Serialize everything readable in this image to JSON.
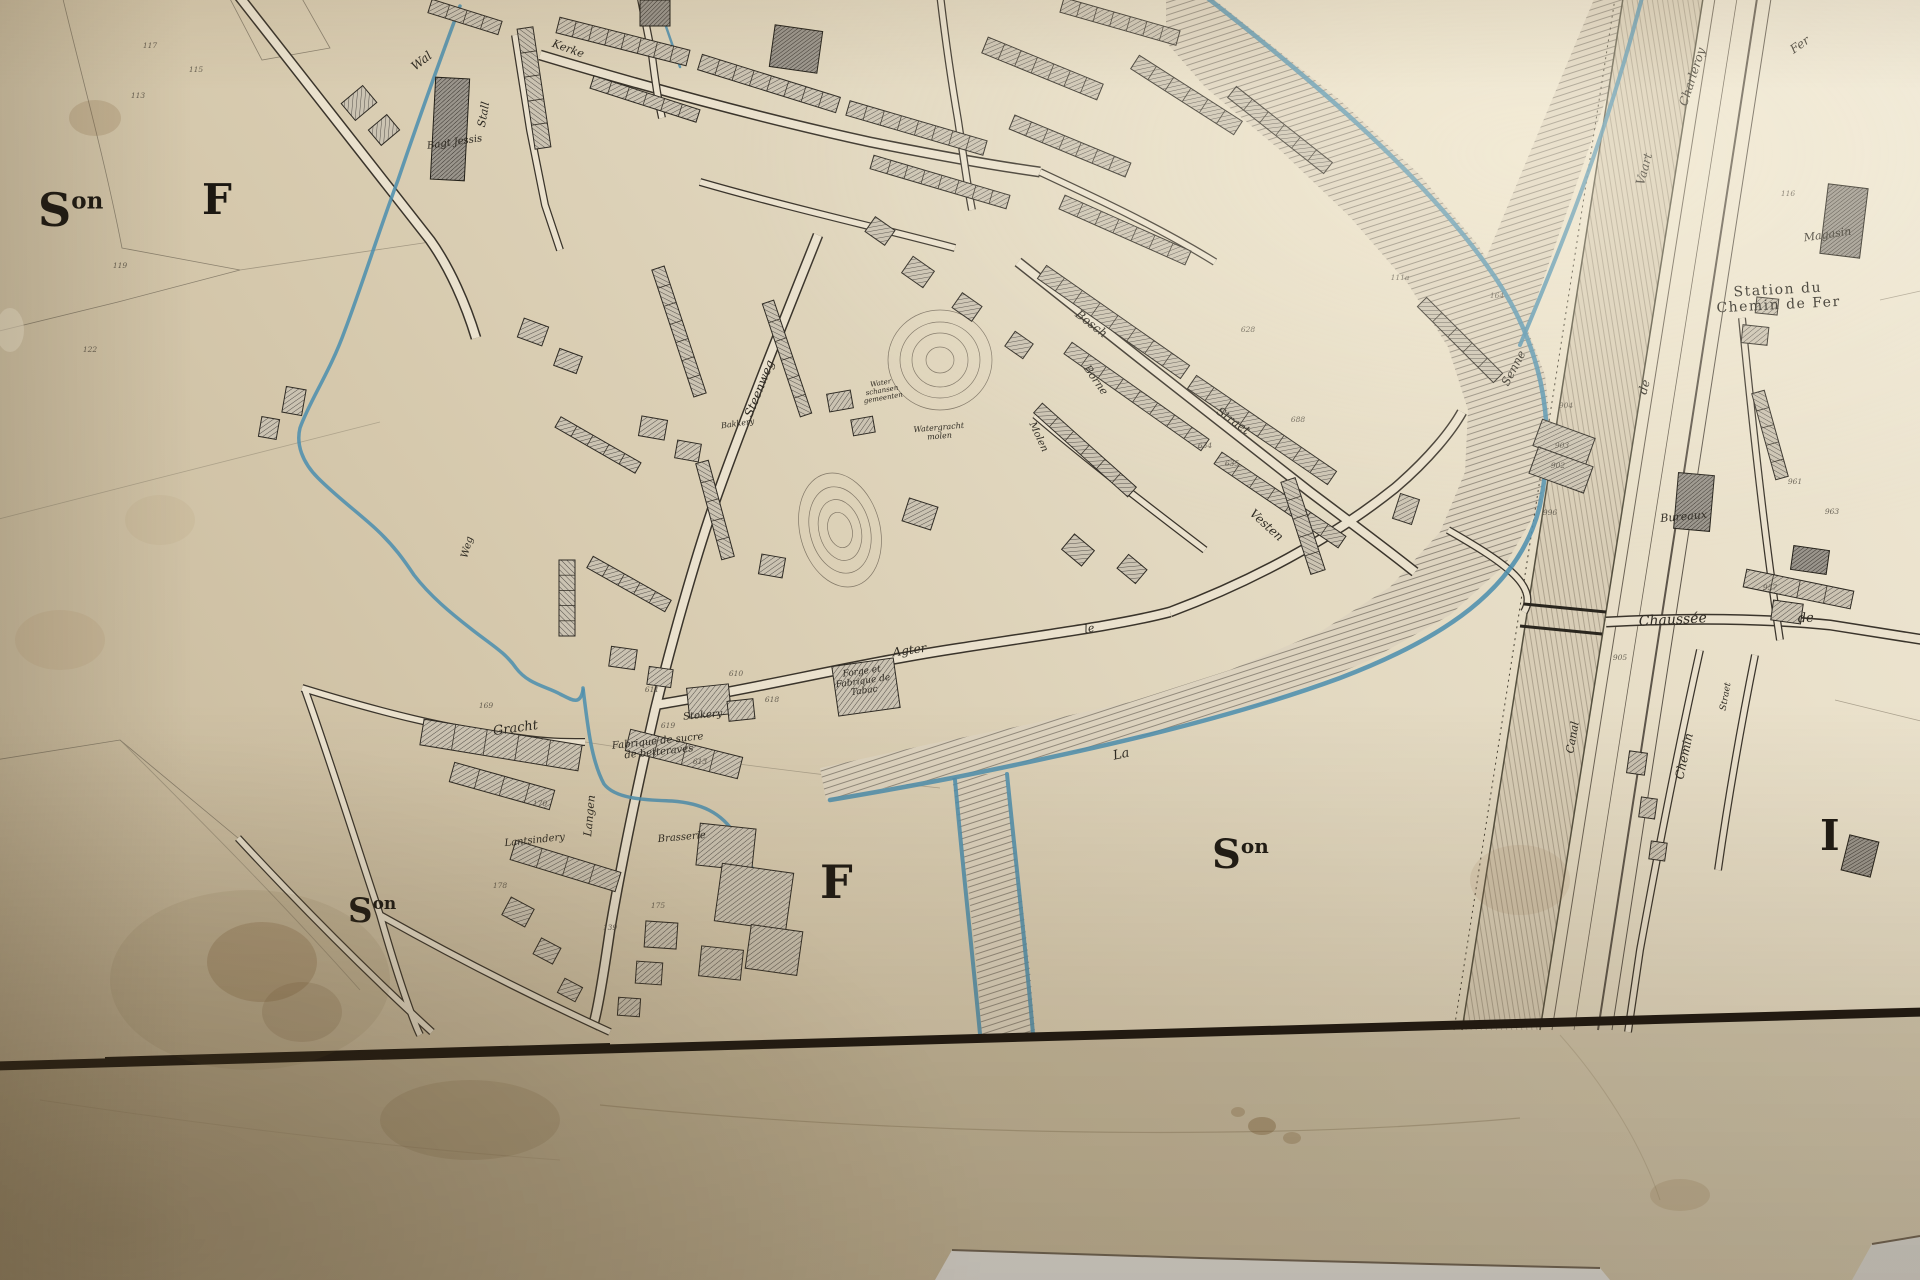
{
  "meta": {
    "description_label": "Photograph of a 19th-century cadastral town plan"
  },
  "colors": {
    "paper_highlight": "#efe8d6",
    "paper_mid": "#e0d5bc",
    "paper_shadow": "#c2b396",
    "ink": "#2e2a22",
    "water": "#4e8fae",
    "building_fill": "#cbc3b2",
    "building_dark": "#8f897c",
    "border_black": "#17120d",
    "canal_fill": "#d8cdb6",
    "table_white": "#e3e2de"
  },
  "map": {
    "section_letters": [
      {
        "t": "S",
        "sup": "on",
        "x": 38,
        "y": 226,
        "s": 46
      },
      {
        "t": "F",
        "x": 202,
        "y": 214,
        "s": 42
      },
      {
        "t": "S",
        "sup": "on",
        "x": 1212,
        "y": 868,
        "s": 40
      },
      {
        "t": "F",
        "x": 820,
        "y": 898,
        "s": 46
      },
      {
        "t": "S",
        "sup": "on",
        "x": 348,
        "y": 922,
        "s": 34
      },
      {
        "t": "I",
        "x": 1820,
        "y": 850,
        "s": 42
      }
    ],
    "labels": [
      {
        "t": "Wal",
        "x": 424,
        "y": 64,
        "s": 12,
        "r": -38,
        "st": "c"
      },
      {
        "t": "Stall",
        "x": 487,
        "y": 115,
        "s": 11,
        "r": -80,
        "st": "c"
      },
      {
        "t": "Kerke",
        "x": 567,
        "y": 52,
        "s": 11,
        "r": 20,
        "st": "c"
      },
      {
        "t": "Bagt Jessis",
        "x": 455,
        "y": 145,
        "s": 10,
        "r": -8,
        "st": "c"
      },
      {
        "t": "Steenweg",
        "x": 763,
        "y": 390,
        "s": 12,
        "r": -68,
        "st": "c"
      },
      {
        "t": "Bakkery",
        "x": 738,
        "y": 426,
        "s": 8,
        "r": -8,
        "st": "c"
      },
      {
        "t": "Bosch",
        "x": 1089,
        "y": 327,
        "s": 12,
        "r": 38,
        "st": "c"
      },
      {
        "t": "Borne",
        "x": 1093,
        "y": 382,
        "s": 11,
        "r": 55,
        "st": "c"
      },
      {
        "t": "Straet",
        "x": 1231,
        "y": 424,
        "s": 12,
        "r": 35,
        "st": "c"
      },
      {
        "t": "Vesten",
        "x": 1264,
        "y": 528,
        "s": 12,
        "r": 42,
        "st": "c"
      },
      {
        "t": "Molen",
        "x": 1036,
        "y": 438,
        "s": 10,
        "r": 65,
        "st": "c"
      },
      {
        "t": [
          "Water",
          "schansen",
          "gemeenten"
        ],
        "x": 881,
        "y": 385,
        "s": 7,
        "r": -10,
        "st": "c"
      },
      {
        "t": [
          "Watergracht",
          "molen"
        ],
        "x": 939,
        "y": 430,
        "s": 8,
        "r": -5,
        "st": "c"
      },
      {
        "t": "Agter",
        "x": 910,
        "y": 654,
        "s": 12,
        "r": -8,
        "st": "c"
      },
      {
        "t": "le",
        "x": 1090,
        "y": 632,
        "s": 11,
        "r": -10,
        "st": "c"
      },
      {
        "t": "Senne",
        "x": 1517,
        "y": 370,
        "s": 12,
        "r": -62,
        "st": "c"
      },
      {
        "t": "La",
        "x": 1122,
        "y": 758,
        "s": 13,
        "r": -12,
        "st": "c"
      },
      {
        "t": "Vaart",
        "x": 1648,
        "y": 170,
        "s": 12,
        "r": -75,
        "st": "c"
      },
      {
        "t": "Charleroy",
        "x": 1696,
        "y": 78,
        "s": 12,
        "r": -72,
        "st": "c"
      },
      {
        "t": "Fer",
        "x": 1802,
        "y": 48,
        "s": 12,
        "r": -35,
        "st": "c"
      },
      {
        "t": [
          "Station du",
          "Chemin de Fer"
        ],
        "x": 1778,
        "y": 294,
        "s": 14,
        "r": -3,
        "st": "sc"
      },
      {
        "t": "Magasin",
        "x": 1828,
        "y": 238,
        "s": 11,
        "r": -8,
        "st": "c"
      },
      {
        "t": "Bureaux",
        "x": 1684,
        "y": 520,
        "s": 11,
        "r": -5,
        "st": "c"
      },
      {
        "t": "Chaussée",
        "x": 1673,
        "y": 624,
        "s": 14,
        "r": -3,
        "st": "c"
      },
      {
        "t": "de",
        "x": 1806,
        "y": 622,
        "s": 13,
        "r": -3,
        "st": "c"
      },
      {
        "t": "de",
        "x": 1648,
        "y": 388,
        "s": 12,
        "r": -75,
        "st": "c"
      },
      {
        "t": "Chemin",
        "x": 1688,
        "y": 757,
        "s": 12,
        "r": -78,
        "st": "c"
      },
      {
        "t": "Straet",
        "x": 1728,
        "y": 697,
        "s": 9,
        "r": -80,
        "st": "c"
      },
      {
        "t": "Canal",
        "x": 1576,
        "y": 738,
        "s": 11,
        "r": -80,
        "st": "c"
      },
      {
        "t": "Gracht",
        "x": 516,
        "y": 732,
        "s": 13,
        "r": -8,
        "st": "c"
      },
      {
        "t": "Langen",
        "x": 593,
        "y": 816,
        "s": 11,
        "r": -85,
        "st": "c"
      },
      {
        "t": "Lantsindery",
        "x": 535,
        "y": 843,
        "s": 10,
        "r": -6,
        "st": "c"
      },
      {
        "t": "Brasserie",
        "x": 682,
        "y": 840,
        "s": 10,
        "r": -5,
        "st": "c"
      },
      {
        "t": "Stokery",
        "x": 703,
        "y": 718,
        "s": 10,
        "r": -5,
        "st": "c"
      },
      {
        "t": [
          "Fabrique de sucre",
          "de betteraves"
        ],
        "x": 658,
        "y": 744,
        "s": 10,
        "r": -6,
        "st": "c"
      },
      {
        "t": [
          "Forge et",
          "Fabrique de",
          "Tabac"
        ],
        "x": 862,
        "y": 674,
        "s": 9,
        "r": -8,
        "st": "c"
      },
      {
        "t": "Weg",
        "x": 470,
        "y": 548,
        "s": 10,
        "r": -75,
        "st": "c"
      }
    ],
    "numbers": [
      {
        "t": "117",
        "x": 150,
        "y": 48
      },
      {
        "t": "113",
        "x": 138,
        "y": 98
      },
      {
        "t": "115",
        "x": 196,
        "y": 72
      },
      {
        "t": "119",
        "x": 120,
        "y": 268
      },
      {
        "t": "122",
        "x": 90,
        "y": 352
      },
      {
        "t": "169",
        "x": 486,
        "y": 708
      },
      {
        "t": "170",
        "x": 540,
        "y": 806
      },
      {
        "t": "613",
        "x": 700,
        "y": 764
      },
      {
        "t": "619",
        "x": 668,
        "y": 728
      },
      {
        "t": "618",
        "x": 772,
        "y": 702
      },
      {
        "t": "611",
        "x": 652,
        "y": 692
      },
      {
        "t": "610",
        "x": 736,
        "y": 676
      },
      {
        "t": "178",
        "x": 500,
        "y": 888
      },
      {
        "t": "175",
        "x": 658,
        "y": 908
      },
      {
        "t": "139",
        "x": 610,
        "y": 930
      },
      {
        "t": "111a",
        "x": 1400,
        "y": 280
      },
      {
        "t": "164",
        "x": 1497,
        "y": 298
      },
      {
        "t": "904",
        "x": 1566,
        "y": 408
      },
      {
        "t": "903",
        "x": 1562,
        "y": 448
      },
      {
        "t": "902",
        "x": 1558,
        "y": 468
      },
      {
        "t": "996",
        "x": 1550,
        "y": 515
      },
      {
        "t": "957",
        "x": 1770,
        "y": 590
      },
      {
        "t": "961",
        "x": 1795,
        "y": 484
      },
      {
        "t": "963",
        "x": 1832,
        "y": 514
      },
      {
        "t": "116",
        "x": 1788,
        "y": 196
      },
      {
        "t": "628",
        "x": 1248,
        "y": 332
      },
      {
        "t": "688",
        "x": 1298,
        "y": 422
      },
      {
        "t": "635",
        "x": 1232,
        "y": 466
      },
      {
        "t": "634",
        "x": 1205,
        "y": 448
      },
      {
        "t": "905",
        "x": 1620,
        "y": 660
      }
    ],
    "terraces": [
      [
        525,
        28,
        543,
        148,
        16,
        5
      ],
      [
        558,
        25,
        688,
        58,
        16,
        8
      ],
      [
        700,
        62,
        838,
        105,
        16,
        8
      ],
      [
        848,
        108,
        985,
        148,
        15,
        8
      ],
      [
        592,
        82,
        698,
        116,
        13,
        6
      ],
      [
        430,
        6,
        500,
        28,
        14,
        4
      ],
      [
        985,
        45,
        1100,
        92,
        17,
        7
      ],
      [
        1012,
        122,
        1128,
        170,
        15,
        7
      ],
      [
        1135,
        62,
        1238,
        128,
        16,
        6
      ],
      [
        1062,
        5,
        1178,
        38,
        15,
        7
      ],
      [
        872,
        162,
        1008,
        202,
        14,
        8
      ],
      [
        1062,
        202,
        1188,
        258,
        15,
        7
      ],
      [
        1042,
        272,
        1185,
        372,
        16,
        8
      ],
      [
        1192,
        382,
        1332,
        478,
        16,
        8
      ],
      [
        1068,
        348,
        1205,
        445,
        14,
        8
      ],
      [
        1218,
        458,
        1342,
        542,
        14,
        7
      ],
      [
        1038,
        408,
        1132,
        492,
        13,
        6
      ],
      [
        1422,
        302,
        1498,
        378,
        13,
        5
      ],
      [
        1232,
        92,
        1328,
        168,
        14,
        6
      ],
      [
        658,
        268,
        700,
        395,
        13,
        7
      ],
      [
        768,
        302,
        806,
        415,
        12,
        6
      ],
      [
        590,
        562,
        668,
        606,
        13,
        5
      ],
      [
        702,
        462,
        728,
        558,
        13,
        5
      ],
      [
        558,
        422,
        638,
        468,
        12,
        5
      ],
      [
        567,
        560,
        567,
        636,
        16,
        5
      ],
      [
        422,
        732,
        580,
        758,
        26,
        5
      ],
      [
        452,
        772,
        552,
        800,
        20,
        4
      ],
      [
        513,
        850,
        618,
        882,
        20,
        4
      ],
      [
        1288,
        480,
        1318,
        572,
        15,
        5
      ],
      [
        1758,
        392,
        1782,
        478,
        13,
        5
      ],
      [
        628,
        740,
        740,
        768,
        22,
        4
      ],
      [
        1745,
        578,
        1852,
        600,
        18,
        4
      ]
    ],
    "buildings": [
      [
        1824,
        186,
        40,
        70,
        7,
        1
      ],
      [
        1676,
        474,
        36,
        56,
        5,
        1
      ],
      [
        433,
        78,
        34,
        102,
        3,
        1
      ],
      [
        772,
        28,
        48,
        42,
        8,
        1
      ],
      [
        640,
        0,
        30,
        26,
        0,
        1
      ],
      [
        835,
        662,
        62,
        50,
        -8,
        0
      ],
      [
        688,
        686,
        42,
        30,
        -6,
        0
      ],
      [
        728,
        700,
        26,
        20,
        -6,
        0
      ],
      [
        698,
        826,
        56,
        42,
        6,
        0
      ],
      [
        718,
        868,
        72,
        58,
        8,
        0
      ],
      [
        748,
        928,
        52,
        44,
        8,
        0
      ],
      [
        645,
        922,
        32,
        26,
        4,
        0
      ],
      [
        636,
        962,
        26,
        22,
        4,
        0
      ],
      [
        700,
        948,
        42,
        30,
        6,
        0
      ],
      [
        618,
        998,
        22,
        18,
        4,
        0
      ],
      [
        505,
        902,
        26,
        20,
        28,
        0
      ],
      [
        536,
        942,
        22,
        18,
        28,
        0
      ],
      [
        560,
        982,
        20,
        16,
        28,
        0
      ],
      [
        284,
        388,
        20,
        26,
        10,
        0
      ],
      [
        260,
        418,
        18,
        20,
        10,
        0
      ],
      [
        1396,
        496,
        20,
        26,
        18,
        0
      ],
      [
        1536,
        428,
        56,
        28,
        20,
        0
      ],
      [
        1532,
        456,
        58,
        28,
        20,
        0
      ],
      [
        1628,
        752,
        18,
        22,
        8,
        0
      ],
      [
        1640,
        798,
        16,
        20,
        8,
        0
      ],
      [
        1650,
        842,
        16,
        18,
        8,
        0
      ],
      [
        1845,
        838,
        30,
        36,
        14,
        1
      ],
      [
        905,
        502,
        30,
        24,
        18,
        0
      ],
      [
        760,
        556,
        24,
        20,
        10,
        0
      ],
      [
        1742,
        326,
        26,
        18,
        6,
        0
      ],
      [
        1756,
        298,
        22,
        16,
        6,
        0
      ],
      [
        1792,
        548,
        36,
        24,
        8,
        1
      ],
      [
        1772,
        602,
        30,
        20,
        8,
        0
      ],
      [
        345,
        92,
        28,
        22,
        -40,
        0
      ],
      [
        372,
        120,
        24,
        20,
        -40,
        0
      ],
      [
        905,
        262,
        26,
        20,
        35,
        0
      ],
      [
        955,
        298,
        24,
        18,
        35,
        0
      ],
      [
        1008,
        336,
        22,
        18,
        35,
        0
      ],
      [
        868,
        222,
        24,
        18,
        35,
        0
      ],
      [
        520,
        322,
        26,
        20,
        20,
        0
      ],
      [
        556,
        352,
        24,
        18,
        20,
        0
      ],
      [
        640,
        418,
        26,
        20,
        10,
        0
      ],
      [
        676,
        442,
        24,
        18,
        10,
        0
      ],
      [
        828,
        392,
        24,
        18,
        -10,
        0
      ],
      [
        852,
        418,
        22,
        16,
        -10,
        0
      ],
      [
        1065,
        540,
        26,
        20,
        40,
        0
      ],
      [
        1120,
        560,
        24,
        18,
        40,
        0
      ],
      [
        610,
        648,
        26,
        20,
        8,
        0
      ],
      [
        648,
        668,
        24,
        18,
        8,
        0
      ]
    ]
  }
}
